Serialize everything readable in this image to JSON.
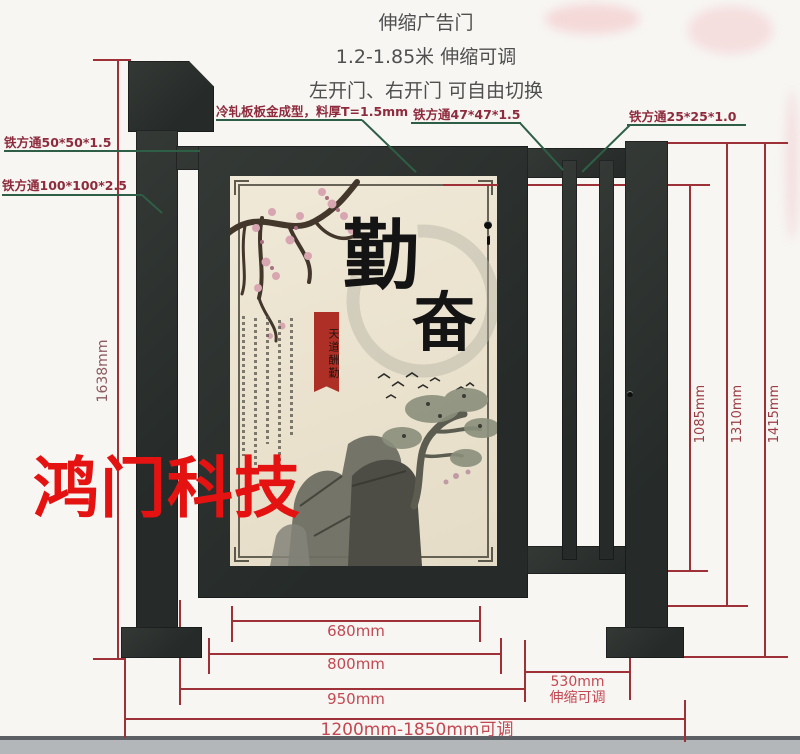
{
  "header": {
    "line1": "伸缩广告门",
    "line2": "1.2-1.85米 伸缩可调",
    "line3": "左开门、右开门 可自由切换"
  },
  "callouts": {
    "tube50": "铁方通50*50*1.5",
    "tube100": "铁方通100*100*2.5",
    "cold_plate": "冷轧板板金成型，料厚T=1.5mm",
    "tube47": "铁方通47*47*1.5",
    "tube25": "铁方通25*25*1.0"
  },
  "dimensions": {
    "total_height": "1638mm",
    "inner_height": "1085mm",
    "fence_height": "1310mm",
    "post_height": "1415mm",
    "poster_width": "680mm",
    "door_width": "800mm",
    "door_total_width": "950mm",
    "ext_width": "530mm",
    "ext_note": "伸缩可调",
    "total_width": "1200mm-1850mm可调"
  },
  "poster": {
    "char_top": "勤",
    "char_bottom": "奋",
    "seal_text": "天道酬勤"
  },
  "watermark": "鸿门科技",
  "colors": {
    "dim_line": "#9e3138",
    "dim_text": "#c34852",
    "leader_line": "#2e5f46",
    "leader_text": "#8e2b3c",
    "gate_metal": "#2c312f",
    "poster_bg": "#ece5d2",
    "watermark_red": "#e41312",
    "seal_red": "#ae2f26"
  }
}
